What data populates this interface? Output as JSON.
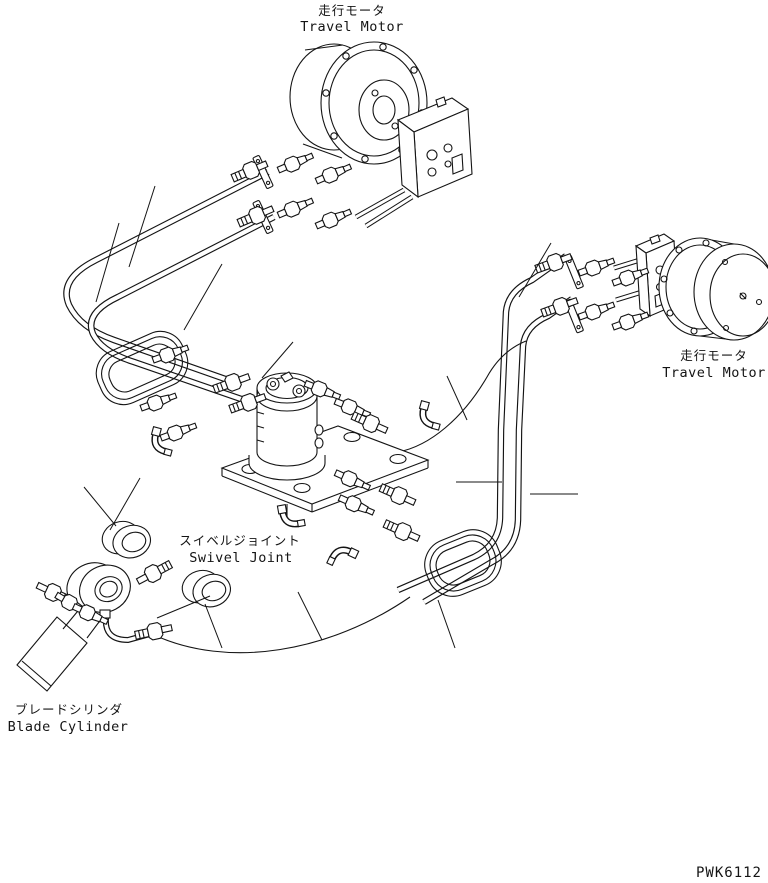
{
  "diagram": {
    "part_code": "PWK6112",
    "background_color": "#ffffff",
    "line_color": "#141414",
    "labels": {
      "travel_motor_top": {
        "jp": "走行モータ",
        "en": "Travel Motor"
      },
      "travel_motor_right": {
        "jp": "走行モータ",
        "en": "Travel Motor"
      },
      "swivel_joint": {
        "jp": "スイベルジョイント",
        "en": "Swivel Joint"
      },
      "blade_cylinder": {
        "jp": "ブレードシリンダ",
        "en": "Blade Cylinder"
      }
    }
  }
}
